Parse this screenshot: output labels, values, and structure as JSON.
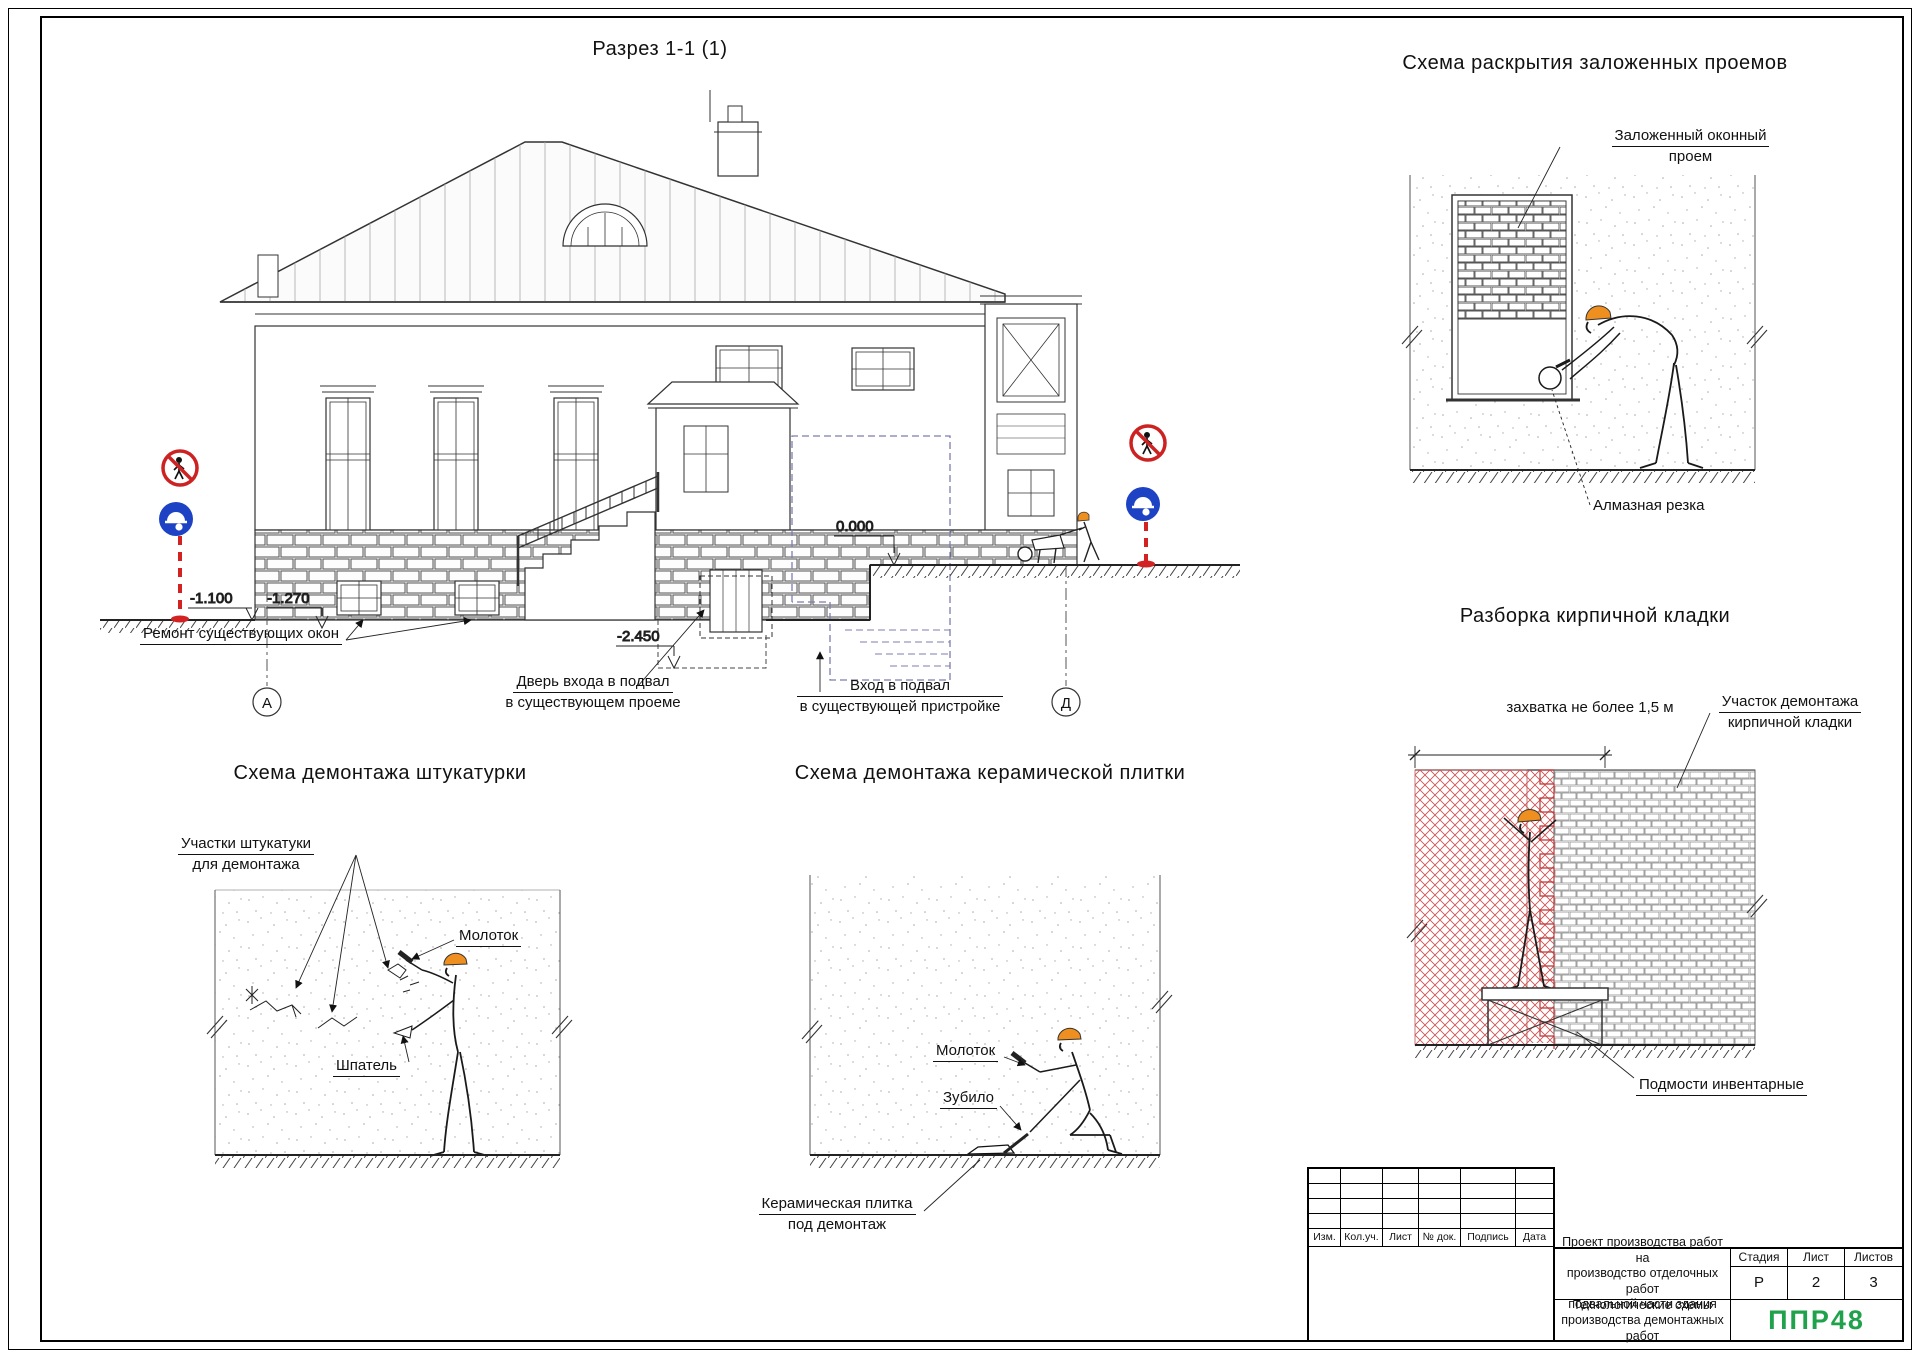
{
  "colors": {
    "logo_green": "#1fa24b",
    "helmet_orange": "#ef8f1f",
    "sign_red": "#cc2222",
    "sign_blue": "#1d43c4",
    "demolition_red": "#cc5555",
    "extension_dash_blue": "#7d7dae"
  },
  "section": {
    "title": "Разрез 1-1 (1)",
    "elevations": {
      "left1": "-1.100",
      "left2": "-1.270",
      "right": "0.000",
      "basement": "-2.450"
    },
    "axes": {
      "left": "А",
      "right": "Д"
    },
    "labels": {
      "repair_windows": "Ремонт существующих окон",
      "door_line1": "Дверь входа в подвал",
      "door_line2": "в существующем проеме",
      "entry_line1": "Вход в подвал",
      "entry_line2": "в существующей пристройке"
    }
  },
  "opening_scheme": {
    "title": "Схема раскрытия заложенных проемов",
    "label_blocked_line1": "Заложенный оконный",
    "label_blocked_line2": "проем",
    "label_cutting": "Алмазная резка"
  },
  "brick_scheme": {
    "title": "Разборка кирпичной кладки",
    "dim_label": "захватка не более 1,5 м",
    "area_line1": "Участок демонтажа",
    "area_line2": "кирпичной кладки",
    "scaffold": "Подмости инвентарные"
  },
  "plaster_scheme": {
    "title": "Схема демонтажа штукатурки",
    "areas_line1": "Участки штукатуки",
    "areas_line2": "для демонтажа",
    "hammer": "Молоток",
    "spatula": "Шпатель"
  },
  "tile_scheme": {
    "title": "Схема демонтажа керамической плитки",
    "hammer": "Молоток",
    "chisel": "Зубило",
    "tile_line1": "Керамическая плитка",
    "tile_line2": "под демонтаж"
  },
  "title_block": {
    "header_cols": [
      "Изм.",
      "Кол.уч.",
      "Лист",
      "№ док.",
      "Подпись",
      "Дата"
    ],
    "project_line1": "Проект производства работ на",
    "project_line2": "производство отделочных работ",
    "project_line3": "подвальной части здания",
    "stage_label": "Стадия",
    "sheet_label": "Лист",
    "sheets_label": "Листов",
    "stage_value": "Р",
    "sheet_value": "2",
    "sheets_value": "3",
    "doc_line1": "Технологические схемы",
    "doc_line2": "производства демонтажных работ",
    "logo": "ППР48"
  }
}
